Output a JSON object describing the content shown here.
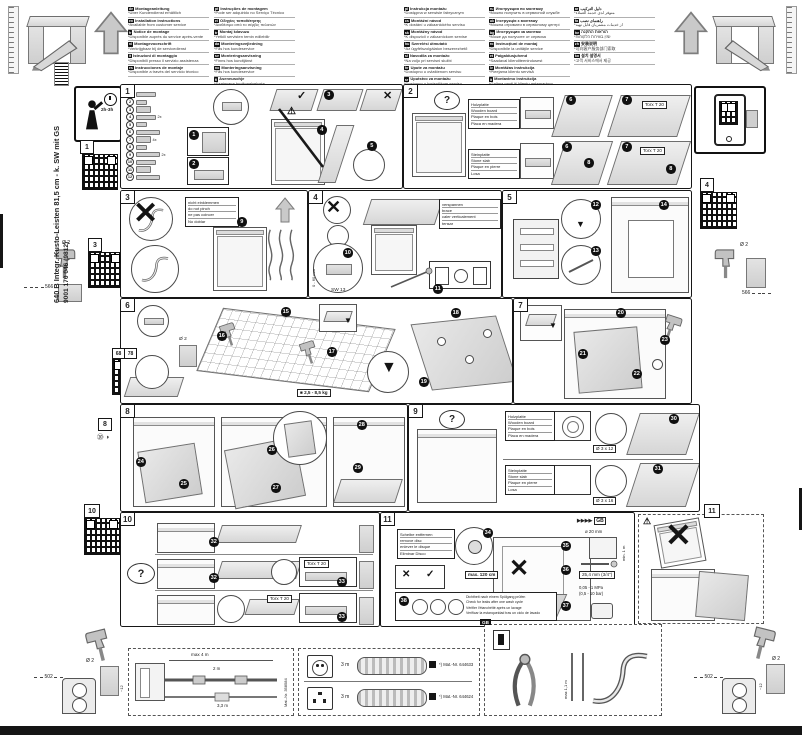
{
  "sidebar": {
    "model": "640 B Integr. Kusto-Leisten 81,5 cm - k. SW mit GS",
    "code": "9001 170 046 (9812)"
  },
  "badge": {
    "time": "2h-3h"
  },
  "qr": {
    "q1": "1",
    "q3": "3",
    "q4": "4",
    "q6": "68",
    "q7": "78",
    "q10": "10",
    "q11": "11",
    "p8tag": "8"
  },
  "marks": {
    "check": "✓",
    "cross": "✕",
    "question": "?",
    "warn": "⚠",
    "chevrons": "▶▶▶▶",
    "gb": "GB",
    "p8_icons": "⑳ ◑",
    "arrow_down": "▼",
    "arrow_up": "▲",
    "weight_icon": "■"
  },
  "header": {
    "columns": [
      [
        {
          "code": "de",
          "title": "Montageanleitung",
          "note": "*Über Kundendienst erhältlich"
        },
        {
          "code": "en",
          "title": "Installation instructions",
          "note": "*Available from customer service"
        },
        {
          "code": "fr",
          "title": "Notice de montage",
          "note": "*Disponible auprès du service après-vente"
        },
        {
          "code": "nl",
          "title": "Montagevoorschrift",
          "note": "*Verkrijgbaar bij de servicedienst"
        },
        {
          "code": "it",
          "title": "Istruzioni di montaggio",
          "note": "*Disponibili presso il servizio assistenza"
        },
        {
          "code": "es",
          "title": "Instrucciones de montaje",
          "note": "*Disponible a través del servicio técnico"
        }
      ],
      [
        {
          "code": "pt",
          "title": "Instruções de montagem",
          "note": "*Pode ser adquirido no Serviço Técnico"
        },
        {
          "code": "el",
          "title": "Οδηγίες τοποθέτησης",
          "note": "*Διαθέσιμο από το σέρβις πελατών"
        },
        {
          "code": "tr",
          "title": "Montaj kılavuzu",
          "note": "*Yetkili servisten temin edilebilir"
        },
        {
          "code": "da",
          "title": "Monteringsvejledning",
          "note": "*Fås hos kundeservice"
        },
        {
          "code": "sv",
          "title": "Monteringsanvisning",
          "note": "*Finns hos kundtjänst"
        },
        {
          "code": "no",
          "title": "Monteringsanvisning",
          "note": "*Fås hos kundeservice"
        },
        {
          "code": "fi",
          "title": "Asennusohje",
          "note": "*Saatavana huoltopalvelusta"
        }
      ],
      [
        {
          "code": "pl",
          "title": "Instrukcja montażu",
          "note": "*Dostępna w serwisie fabrycznym"
        },
        {
          "code": "cs",
          "title": "Montážní návod",
          "note": "*K dostání u zákaznického servisu"
        },
        {
          "code": "sk",
          "title": "Montážny návod",
          "note": "*K dispozícii v zákazníckom servise"
        },
        {
          "code": "hu",
          "title": "Szerelési útmutató",
          "note": "*Az ügyfélszolgálaton beszerezhető"
        },
        {
          "code": "sl",
          "title": "Navodila za montažo",
          "note": "*Na voljo pri servisni službi"
        },
        {
          "code": "hr",
          "title": "Upute za montažu",
          "note": "*Dostupno u ovlaštenom servisu"
        },
        {
          "code": "sr",
          "title": "Uputstvo za montažu",
          "note": "*Dostupno u korisničkom servisu"
        }
      ],
      [
        {
          "code": "ru",
          "title": "Инструкция по монтажу",
          "note": "*Можно получить в сервисной службе"
        },
        {
          "code": "uk",
          "title": "Інструкція з монтажу",
          "note": "*Можна отримати в сервісному центрі"
        },
        {
          "code": "bg",
          "title": "Инструкция за монтаж",
          "note": "*Може да получите от сервиза"
        },
        {
          "code": "ro",
          "title": "Instrucţiuni de montaj",
          "note": "*Disponibile la unităţile service"
        },
        {
          "code": "et",
          "title": "Paigaldusjuhend",
          "note": "*Saadaval klienditeenindusest"
        },
        {
          "code": "lv",
          "title": "Montāžas instrukcija",
          "note": "*Pieejama klientu servisā"
        },
        {
          "code": "lt",
          "title": "Montavimo instrukcija",
          "note": "*Galima gauti iš klientų aptarnavimo"
        }
      ],
      [
        {
          "code": "ar",
          "title": "دليل التركيب",
          "note": "*متوفر لدى خدمة العملاء"
        },
        {
          "code": "fa",
          "title": "راهنمای نصب",
          "note": "*از خدمات مشتریان قابل تهیه"
        },
        {
          "code": "he",
          "title": "הוראות התקנה",
          "note": "*זמין בשירות הלקוחות"
        },
        {
          "code": "zh",
          "title": "安装说明",
          "note": "*可向客户服务部门索取"
        },
        {
          "code": "ko",
          "title": "설치 설명서",
          "note": "*고객 서비스에서 제공"
        }
      ]
    ]
  },
  "panels": {
    "p1": {
      "no": "1",
      "parts": [
        {
          "n": "1",
          "q": ""
        },
        {
          "n": "2",
          "q": ""
        },
        {
          "n": "3",
          "q": ""
        },
        {
          "n": "4",
          "q": "2x"
        },
        {
          "n": "5",
          "q": ""
        },
        {
          "n": "6",
          "q": ""
        },
        {
          "n": "7",
          "q": "4x"
        },
        {
          "n": "8",
          "q": ""
        },
        {
          "n": "9",
          "q": "2x"
        },
        {
          "n": "10",
          "q": ""
        },
        {
          "n": "11",
          "q": ""
        },
        {
          "n": "12",
          "q": ""
        }
      ],
      "callouts": [
        "1",
        "2",
        "3",
        "4",
        "5"
      ]
    },
    "p2": {
      "no": "2",
      "wood": [
        "Holzplatte",
        "Wooden board",
        "Plaque en bois",
        "Placa en madera"
      ],
      "stone": [
        "Steinplatte",
        "Stone slab",
        "Plaque en pierre",
        "Losa"
      ],
      "torx": "Torx T 20",
      "callouts": [
        "6",
        "7",
        "8"
      ]
    },
    "p3": {
      "no": "3",
      "note": [
        "nicht einklemmen",
        "do not pinch",
        "ne pas coincer",
        "No doblar"
      ],
      "callout": "9"
    },
    "p4": {
      "no": "4",
      "note": [
        "verspannen",
        "brace",
        "caler verticalement",
        "tensar"
      ],
      "callouts": [
        "10",
        "11"
      ],
      "sw": "SW 13",
      "range": "0 - 60 mm"
    },
    "p5": {
      "no": "5",
      "callouts": [
        "12",
        "13",
        "14"
      ]
    },
    "p6": {
      "no": "6",
      "callouts": [
        "15",
        "16",
        "17",
        "18",
        "19"
      ],
      "weight": "2,5 - 8,5 kg",
      "drill": "Ø 2"
    },
    "p7": {
      "no": "7",
      "callouts": [
        "20",
        "21",
        "22",
        "23"
      ]
    },
    "p8": {
      "no": "8",
      "callouts": [
        "24",
        "25",
        "26",
        "27",
        "28",
        "29"
      ]
    },
    "p9": {
      "no": "9",
      "wood": [
        "Holzplatte",
        "Wooden board",
        "Plaque en bois",
        "Placa en madera"
      ],
      "stone": [
        "Steinplatte",
        "Stone slab",
        "Plaque en pierre",
        "Losa"
      ],
      "callouts": [
        "30",
        "31"
      ],
      "screw_top": "Ø 3 x 12",
      "screw_bottom": "Ø 3 x 16"
    },
    "p10": {
      "no": "10",
      "callouts": [
        "32",
        "33"
      ],
      "torx": "Torx T 20"
    },
    "p11": {
      "no": "11",
      "disc": [
        "Scheibe entfernen",
        "remove disc",
        "enlever le disque",
        "Eliminar Disco"
      ],
      "max": "max. 120 cm",
      "callouts": [
        "34",
        "35",
        "36",
        "37"
      ],
      "check_no": "38",
      "leak": [
        "Dichtheit nach einem Spülgang prüfen",
        "Check for leaks after one wash cycle",
        "Vérifier l'étanchéité après un lavage",
        "Verificar la estanqueidad tras un ciclo de lavado"
      ],
      "specs": {
        "hose_d": "ø 20 mm",
        "min_len": "min. 1 m",
        "thread": "25,4 mm (3/4\")",
        "pressure_a": "0,05 - 1 MPa",
        "pressure_b": "(0,5 - 10 bar)"
      }
    }
  },
  "bottom": {
    "hose": {
      "max": "max 4 m",
      "d1": "2 m",
      "d2": "3,3 m",
      "mat": "Mat.-Nr. 358584"
    },
    "cords": {
      "c1": {
        "len": "3 m",
        "mat": "*) Mat.-Nr. 644633"
      },
      "c2": {
        "len": "3 m",
        "mat": "*) Mat.-Nr. 644624"
      }
    },
    "gb": {
      "label": "GB",
      "max": "max 1,1 m"
    }
  },
  "dims": {
    "d566": "566",
    "d502": "502",
    "dia2": "Ø 2",
    "depth": "~12"
  }
}
